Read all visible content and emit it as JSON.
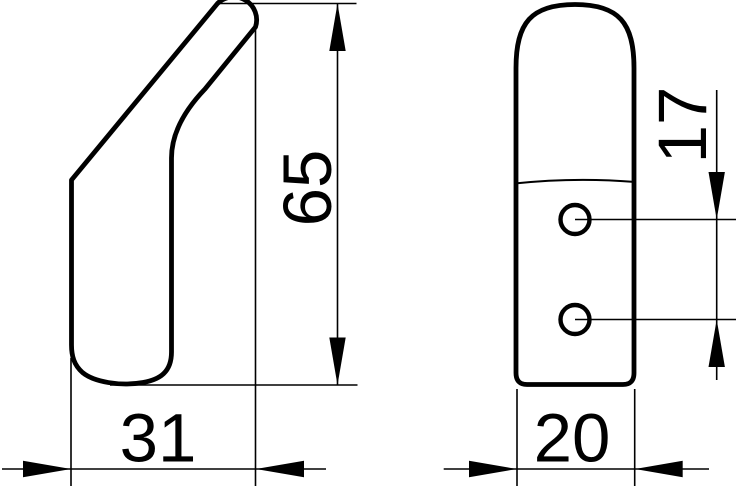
{
  "drawing": {
    "background_color": "#ffffff",
    "line_color": "#000000",
    "dimensions": {
      "side_height": "65",
      "side_depth": "31",
      "front_width": "20",
      "hole_spacing": "17"
    }
  }
}
